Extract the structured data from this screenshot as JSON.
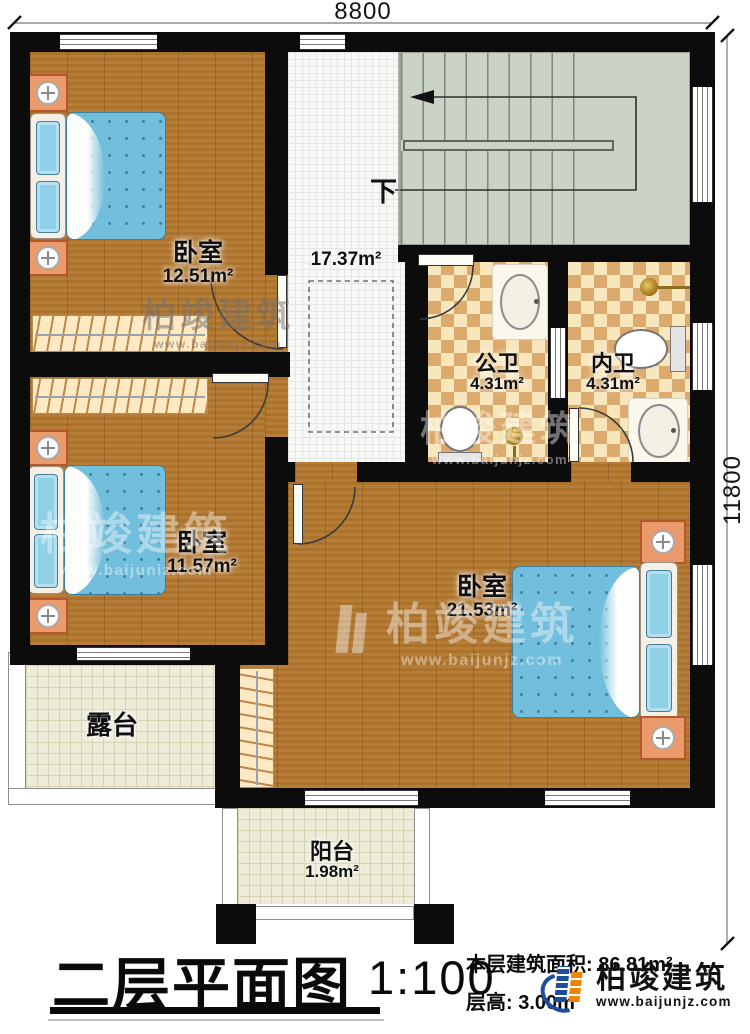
{
  "dimensions": {
    "top": "8800",
    "right": "11800"
  },
  "stairs": {
    "down": "下"
  },
  "rooms": {
    "bedroom1": {
      "name": "卧室",
      "area": "12.51m²"
    },
    "bedroom2": {
      "name": "卧室",
      "area": "11.57m²"
    },
    "bedroom3": {
      "name": "卧室",
      "area": "21.53m²"
    },
    "hall": {
      "area": "17.37m²"
    },
    "public_bath": {
      "name": "公卫",
      "area": "4.31m²"
    },
    "ensuite_bath": {
      "name": "内卫",
      "area": "4.31m²"
    },
    "terrace": {
      "name": "露台"
    },
    "balcony": {
      "name": "阳台",
      "area": "1.98m²"
    }
  },
  "titleblock": {
    "title": "二层平面图",
    "scale": "1:100",
    "area_line": "本层建筑面积: 86.81m²",
    "height_line": "层高: 3.00m"
  },
  "brand": {
    "name": "柏竣建筑",
    "site": "www.baijunjz.com"
  },
  "watermark": {
    "name": "柏竣建筑",
    "site": "www.baijunjz.com"
  },
  "colors": {
    "wall": "#0c0c0c",
    "wood": "#b1762e",
    "stair": "#cbd3c6",
    "tile_light": "#f8e7bd",
    "tile_dark": "#dcaa6c",
    "bed_blue": "#72bedd",
    "brand_blue": "#1b4e9b",
    "brand_orange": "#f08300"
  }
}
